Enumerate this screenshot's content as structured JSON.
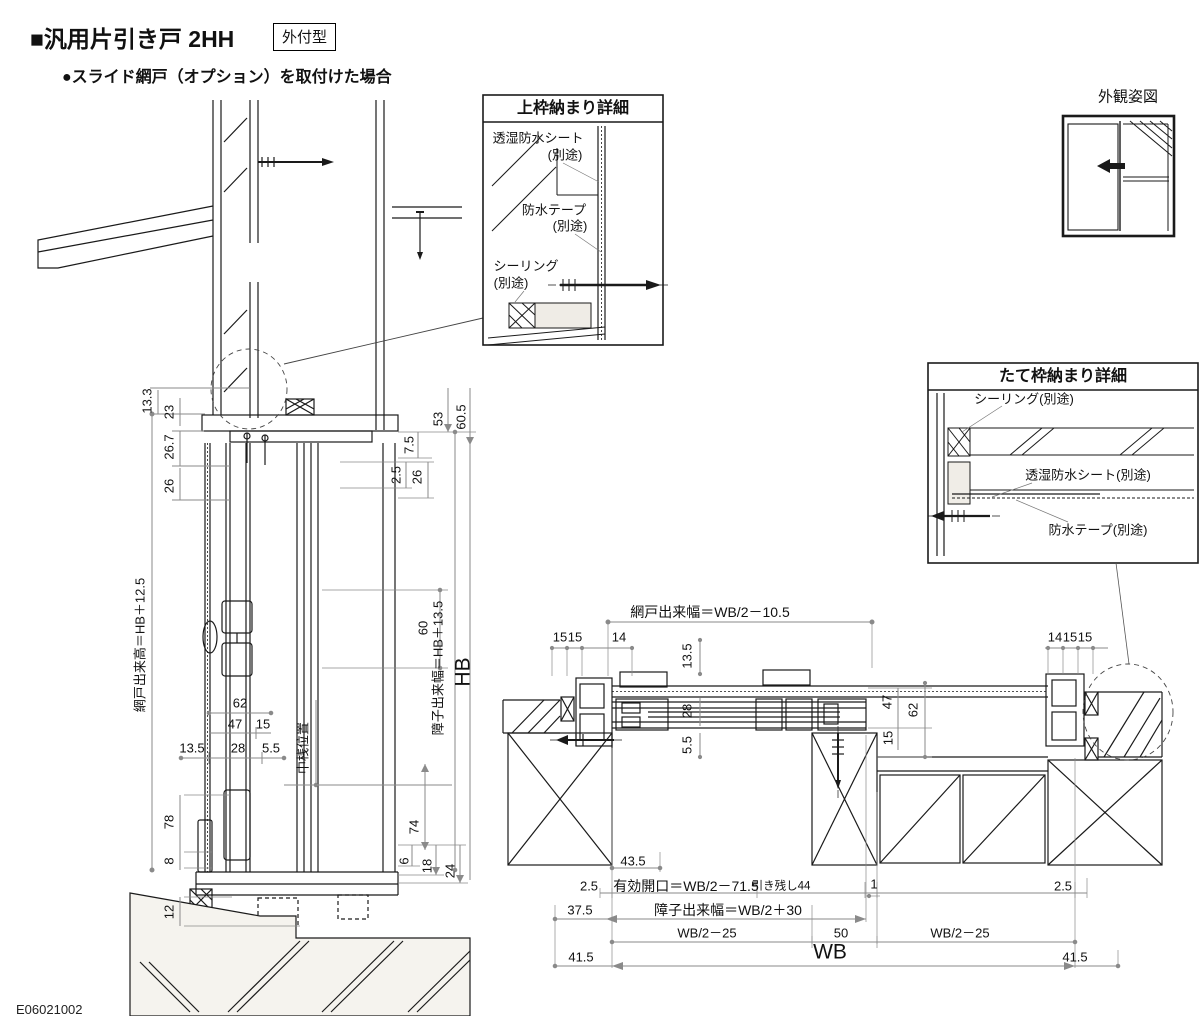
{
  "header": {
    "title": "■汎用片引き戸 2HH",
    "badge": "外付型",
    "subtitle": "●スライド網戸（オプション）を取付けた場合"
  },
  "doc_code": "E06021002",
  "top_detail": {
    "title": "上枠納まり詳細",
    "sheet": "透湿防水シート",
    "sheet_note": "(別途)",
    "tape": "防水テープ",
    "tape_note": "(別途)",
    "seal": "シーリング",
    "seal_note": "(別途)"
  },
  "side_detail": {
    "title": "たて枠納まり詳細",
    "seal": "シーリング(別途)",
    "sheet": "透湿防水シート(別途)",
    "tape": "防水テープ(別途)"
  },
  "appearance": {
    "title": "外観姿図"
  },
  "vsec": {
    "d13_3": "13.3",
    "d23": "23",
    "d26_7": "26.7",
    "d26": "26",
    "mesh_height": "網戸出来高＝HB＋12.5",
    "d78": "78",
    "d8": "8",
    "d12": "12",
    "d62": "62",
    "d47": "47",
    "d15": "15",
    "d13_5": "13.5",
    "d28": "28",
    "d5_5": "5.5",
    "nakasan": "中桟位置",
    "d7_5": "7.5",
    "d53": "53",
    "d60_5": "60.5",
    "d2_5": "2.5",
    "d26r": "26",
    "d60": "60",
    "sash_height": "障子出来幅＝HB＋13.5",
    "hb": "HB",
    "d74": "74",
    "d6": "6",
    "d18": "18",
    "d24": "24"
  },
  "hsec": {
    "mesh_width": "網戸出来幅＝WB/2－10.5",
    "tl1": "15",
    "tl2": "15",
    "tl3": "14",
    "tr1": "14",
    "tr2": "15",
    "tr3": "15",
    "l13_5": "13.5",
    "l28": "28",
    "l5_5": "5.5",
    "r47": "47",
    "r62": "62",
    "r15": "15",
    "d43_5": "43.5",
    "d2_5l": "2.5",
    "opening": "有効開口＝WB/2－71.5",
    "hikinokoshi": "引き残し44",
    "d1": "1",
    "d2_5r": "2.5",
    "d37_5": "37.5",
    "sash_width": "障子出来幅＝WB/2＋30",
    "wb_left": "WB/2－25",
    "d50": "50",
    "wb_right": "WB/2－25",
    "d41_5l": "41.5",
    "wb": "WB",
    "d41_5r": "41.5"
  }
}
